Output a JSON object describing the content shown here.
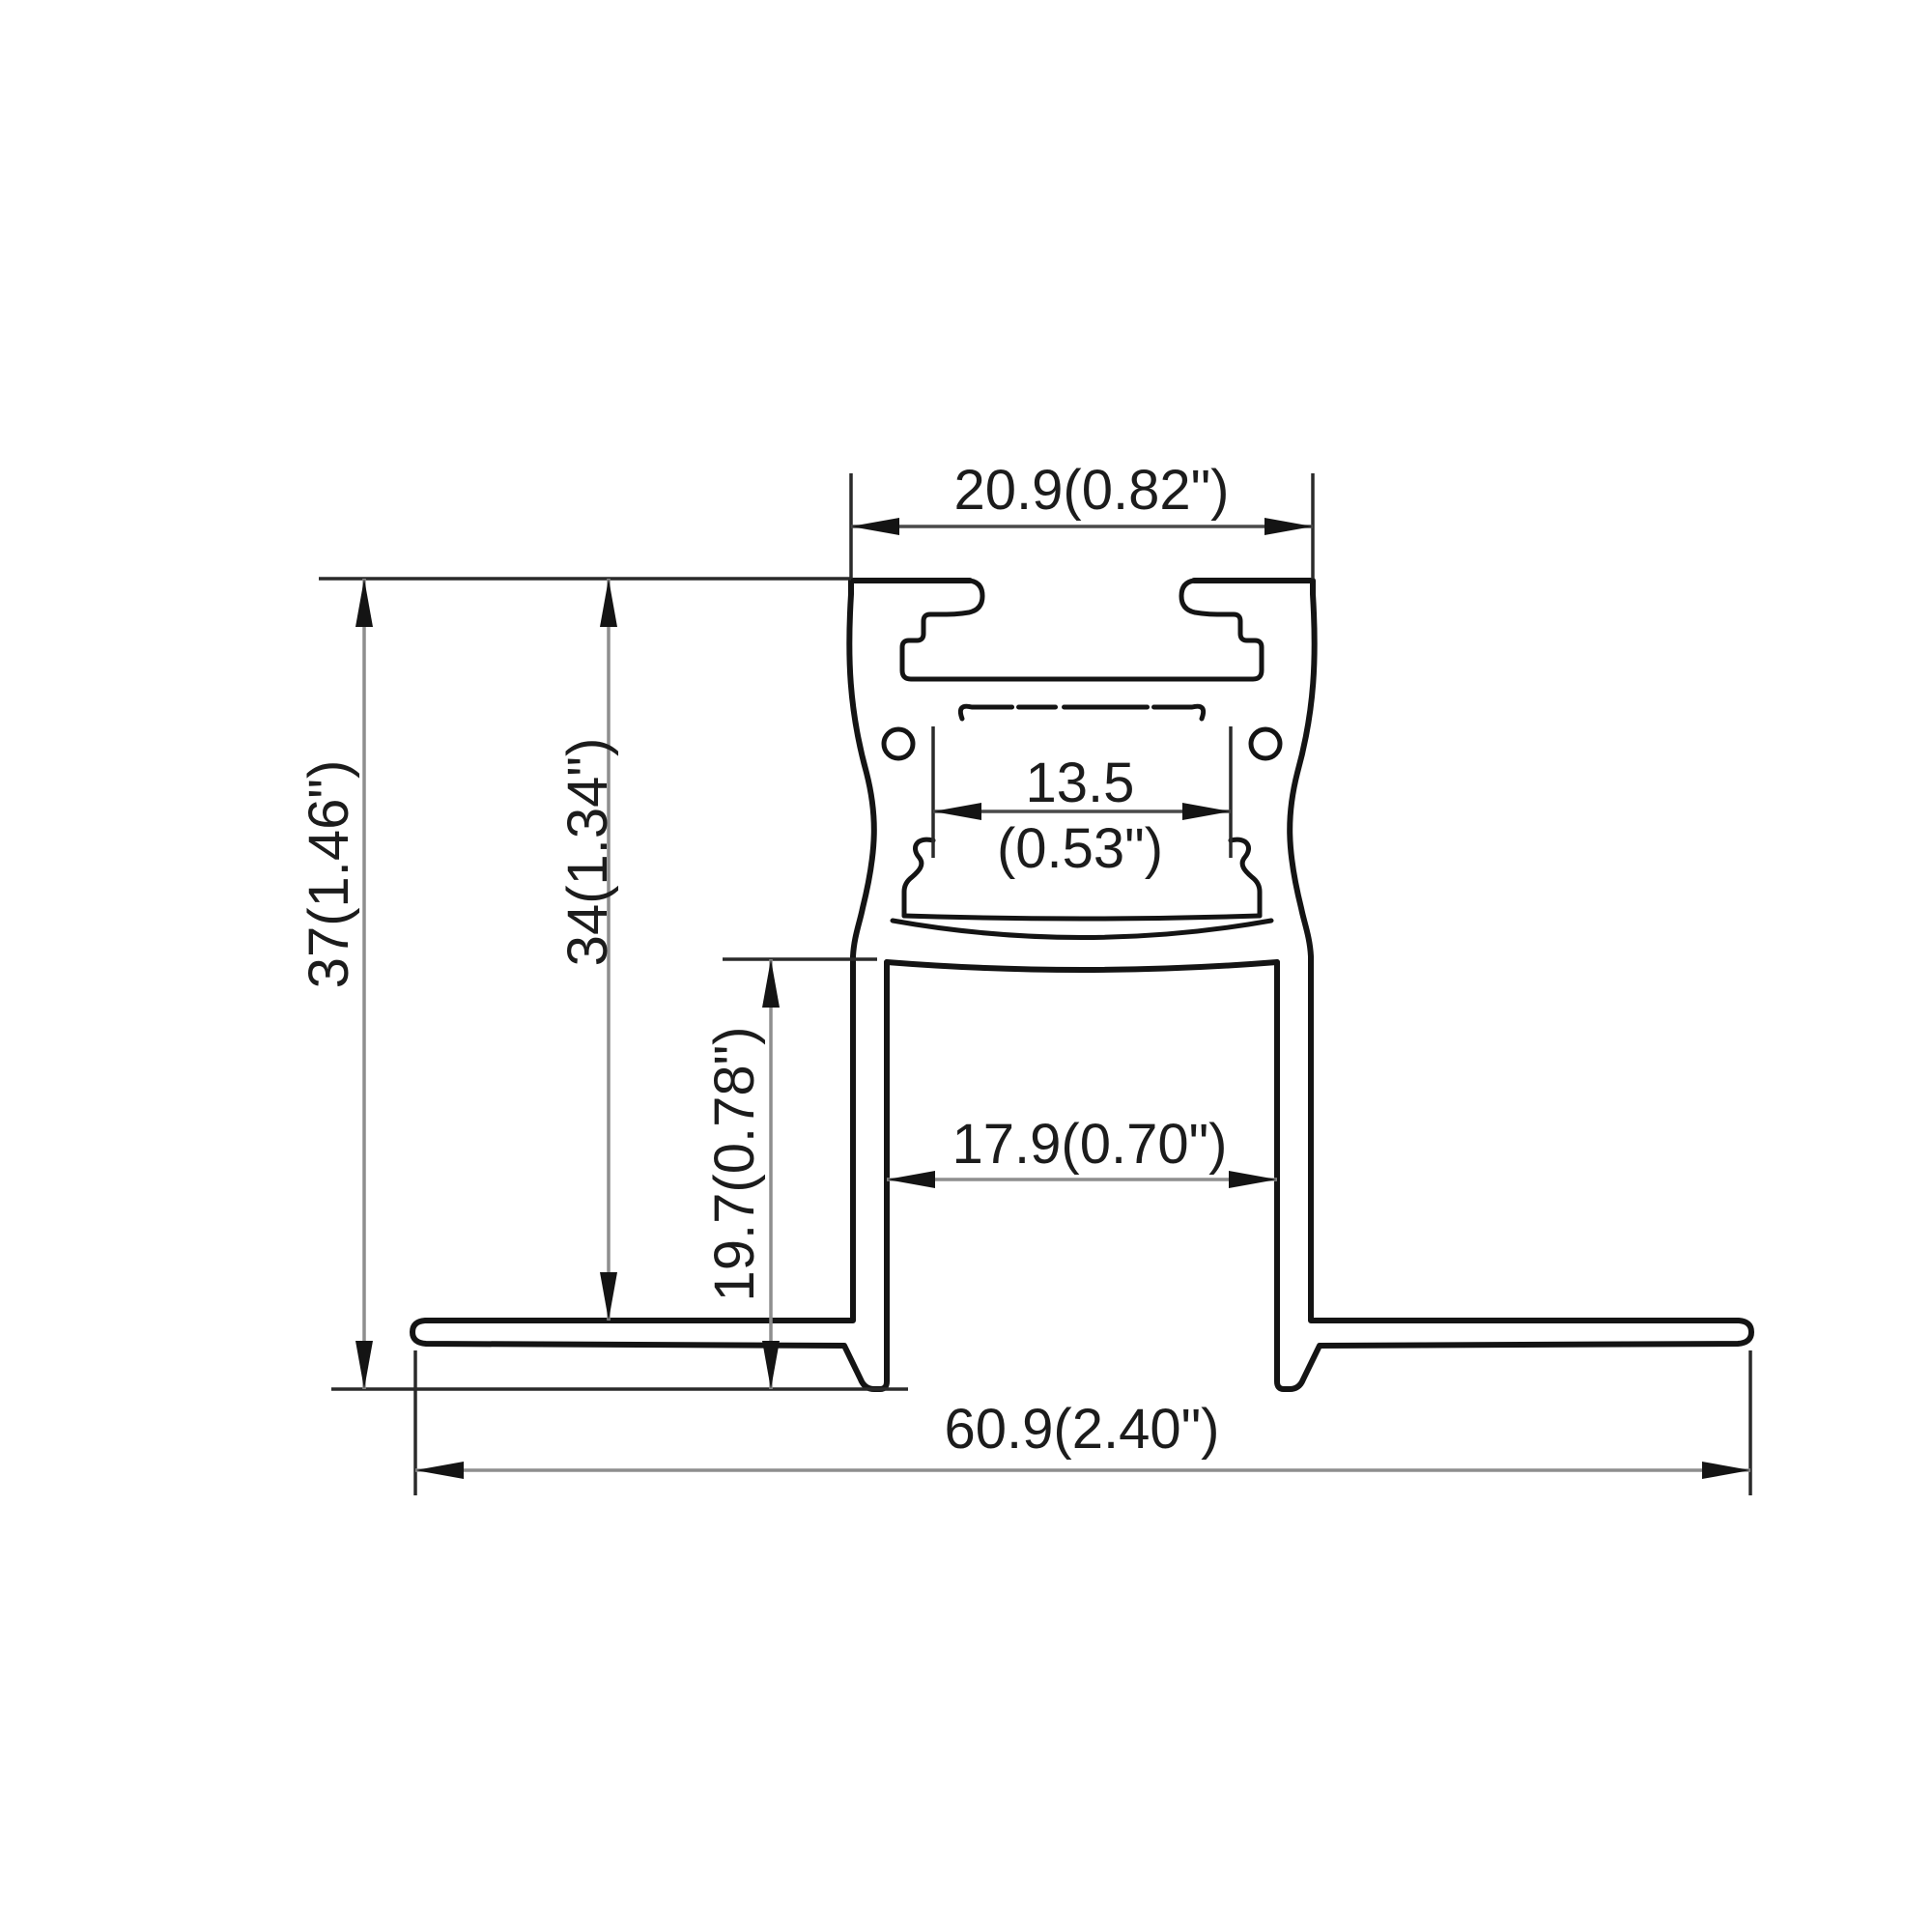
{
  "page": {
    "type": "technical-drawing",
    "subject": "Recessed trimless LED aluminum profile cross-section with dimensions",
    "background": "#ffffff"
  },
  "colors": {
    "outline": "#141414",
    "extension_line": "#2a2a2a",
    "dimension_line": "#8e8e8e",
    "dimension_line_dark": "#4a4a4a",
    "text": "#1c1c1c"
  },
  "dimensions": {
    "top_width": "20.9(0.82\")",
    "slot_width_mm": "13.5",
    "slot_width_in": "(0.53\")",
    "overall_height": "37(1.46\")",
    "recess_height": "34(1.34\")",
    "leg_height": "19.7(0.78\")",
    "opening_width": "17.9(0.70\")",
    "overall_width": "60.9(2.40\")"
  }
}
